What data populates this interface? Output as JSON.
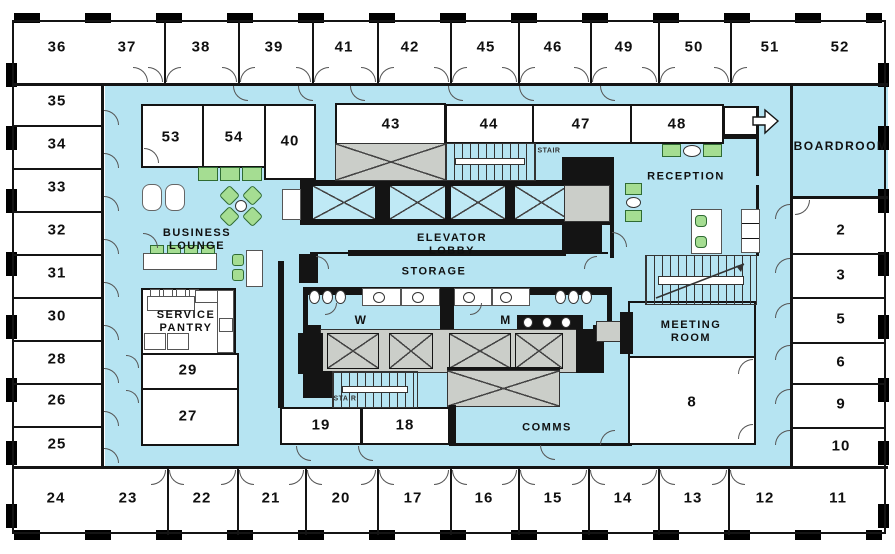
{
  "plan": {
    "rooms": {
      "top": [
        "36",
        "37",
        "38",
        "39",
        "41",
        "42",
        "45",
        "46",
        "49",
        "50",
        "51",
        "52"
      ],
      "left": [
        "35",
        "34",
        "33",
        "32",
        "31",
        "30",
        "28",
        "26",
        "25"
      ],
      "bottom": [
        "24",
        "23",
        "22",
        "21",
        "20",
        "17",
        "16",
        "15",
        "14",
        "13",
        "12",
        "11"
      ],
      "right": [
        "2",
        "3",
        "5",
        "6",
        "9",
        "10"
      ],
      "inner": {
        "r53": "53",
        "r54": "54",
        "r40": "40",
        "r43": "43",
        "r44": "44",
        "r47": "47",
        "r48": "48",
        "r29": "29",
        "r27": "27",
        "r19": "19",
        "r18": "18",
        "r8": "8"
      }
    },
    "areas": {
      "business_lounge": "BUSINESS LOUNGE",
      "service_pantry": "SERVICE PANTRY",
      "elevator_lobby": "ELEVATOR LOBBY",
      "storage": "STORAGE",
      "reception": "RECEPTION",
      "boardroom": "BOARDROOM",
      "meeting_room": "MEETING ROOM",
      "comms": "COMMS",
      "restroom_women": "W",
      "restroom_men": "M",
      "stair_upper": "STAIR",
      "stair_lower": "STAIR"
    },
    "colors": {
      "common_area": "#B6E4F2",
      "furniture_green": "#A5DD92",
      "core_gray": "#CBCEC9",
      "wall": "#141414"
    }
  }
}
